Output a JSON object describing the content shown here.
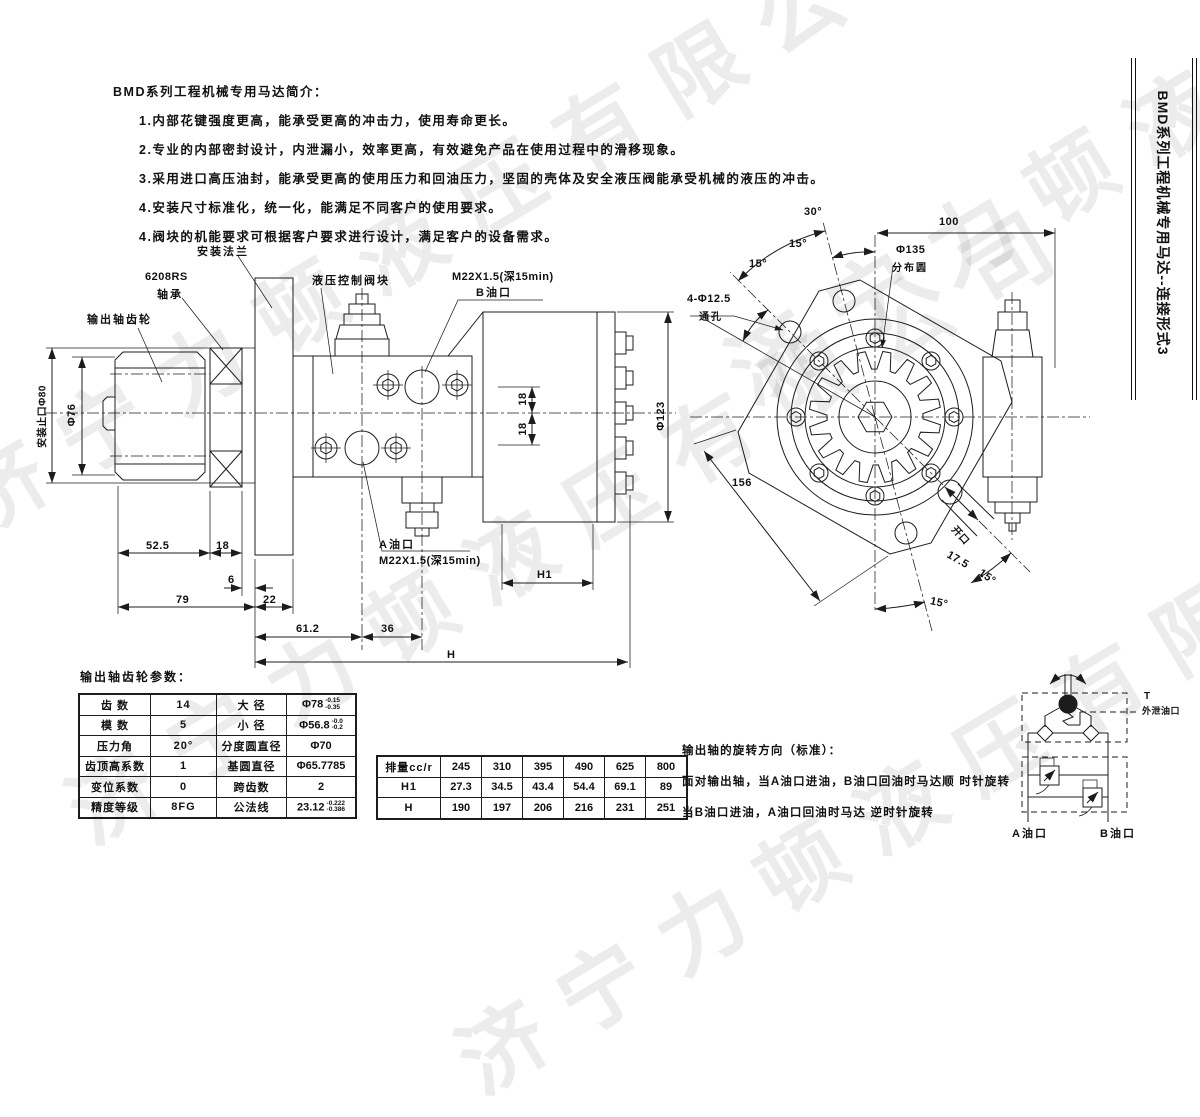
{
  "intro": {
    "title": "BMD系列工程机械专用马达简介：",
    "items": [
      "1.内部花键强度更高，能承受更高的冲击力，使用寿命更长。",
      "2.专业的内部密封设计，内泄漏小，效率更高，有效避免产品在使用过程中的滑移现象。",
      "3.采用进口高压油封，能承受更高的使用压力和回油压力，坚固的壳体及安全液压阀能承受机械的液压的冲击。",
      "4.安装尺寸标准化，统一化，能满足不同客户的使用要求。",
      "4.阀块的机能要求可根据客户要求进行设计，满足客户的设备需求。"
    ]
  },
  "sidebar_title": "BMD系列工程机械专用马达--连接形式3",
  "watermark": "济宁力顿液压有限公司",
  "side_view": {
    "flange_label": "安装法兰",
    "bearing_model": "6208RS",
    "bearing_label": "轴承",
    "gear_label": "输出轴齿轮",
    "valve_block_label": "液压控制阀块",
    "b_port_thread": "M22X1.5(深15min)",
    "b_port_label": "B油口",
    "a_port_label": "A油口",
    "a_port_thread": "M22X1.5(深15min)",
    "spigot_label": "安装止口Φ80",
    "dims": {
      "d76": "Φ76",
      "d123": "Φ123",
      "d18v1": "18",
      "d18v2": "18",
      "d52_5": "52.5",
      "d18": "18",
      "d6": "6",
      "d79": "79",
      "d22": "22",
      "d61_2": "61.2",
      "d36": "36",
      "dH": "H",
      "dH1": "H1"
    }
  },
  "front_view": {
    "a30": "30°",
    "a15_1": "15°",
    "a15_2": "15°",
    "d100": "100",
    "bolt_circle_dia": "Φ135",
    "bolt_circle_label": "分布圆",
    "holes_dia": "4-Φ12.5",
    "holes_label": "通孔",
    "d156": "156",
    "slot_label": "开口",
    "d17_5": "17.5",
    "a15_3": "15°",
    "a15_4": "15°"
  },
  "gear_params": {
    "title": "输出轴齿轮参数：",
    "rows": [
      {
        "c0": "齿 数",
        "c1": "14",
        "c2": "大 径",
        "c3": "Φ78",
        "sup": "-0.15",
        "sub": "-0.35"
      },
      {
        "c0": "模 数",
        "c1": "5",
        "c2": "小 径",
        "c3": "Φ56.8",
        "sup": "-0.0",
        "sub": "-0.2"
      },
      {
        "c0": "压力角",
        "c1": "20°",
        "c2": "分度圆直径",
        "c3": "Φ70"
      },
      {
        "c0": "齿顶高系数",
        "c1": "1",
        "c2": "基圆直径",
        "c3": "Φ65.7785"
      },
      {
        "c0": "变位系数",
        "c1": "0",
        "c2": "跨齿数",
        "c3": "2"
      },
      {
        "c0": "精度等级",
        "c1": "8FG",
        "c2": "公法线",
        "c3": "23.12",
        "sup": "-0.222",
        "sub": "-0.386"
      }
    ]
  },
  "displacement": {
    "header": "排量cc/r",
    "values": [
      "245",
      "310",
      "395",
      "490",
      "625",
      "800"
    ],
    "h1_label": "H1",
    "h1": [
      "27.3",
      "34.5",
      "43.4",
      "54.4",
      "69.1",
      "89"
    ],
    "h_label": "H",
    "h": [
      "190",
      "197",
      "206",
      "216",
      "231",
      "251"
    ]
  },
  "rotation_note": {
    "title": "输出轴的旋转方向（标准）：",
    "line1": "面对输出轴，当A油口进油，B油口回油时马达顺 时针旋转",
    "line2": "当B油口进油，A油口回油时马达 逆时针旋转"
  },
  "schematic": {
    "t": "T",
    "t_label": "外泄油口",
    "a": "A油口",
    "b": "B油口"
  }
}
